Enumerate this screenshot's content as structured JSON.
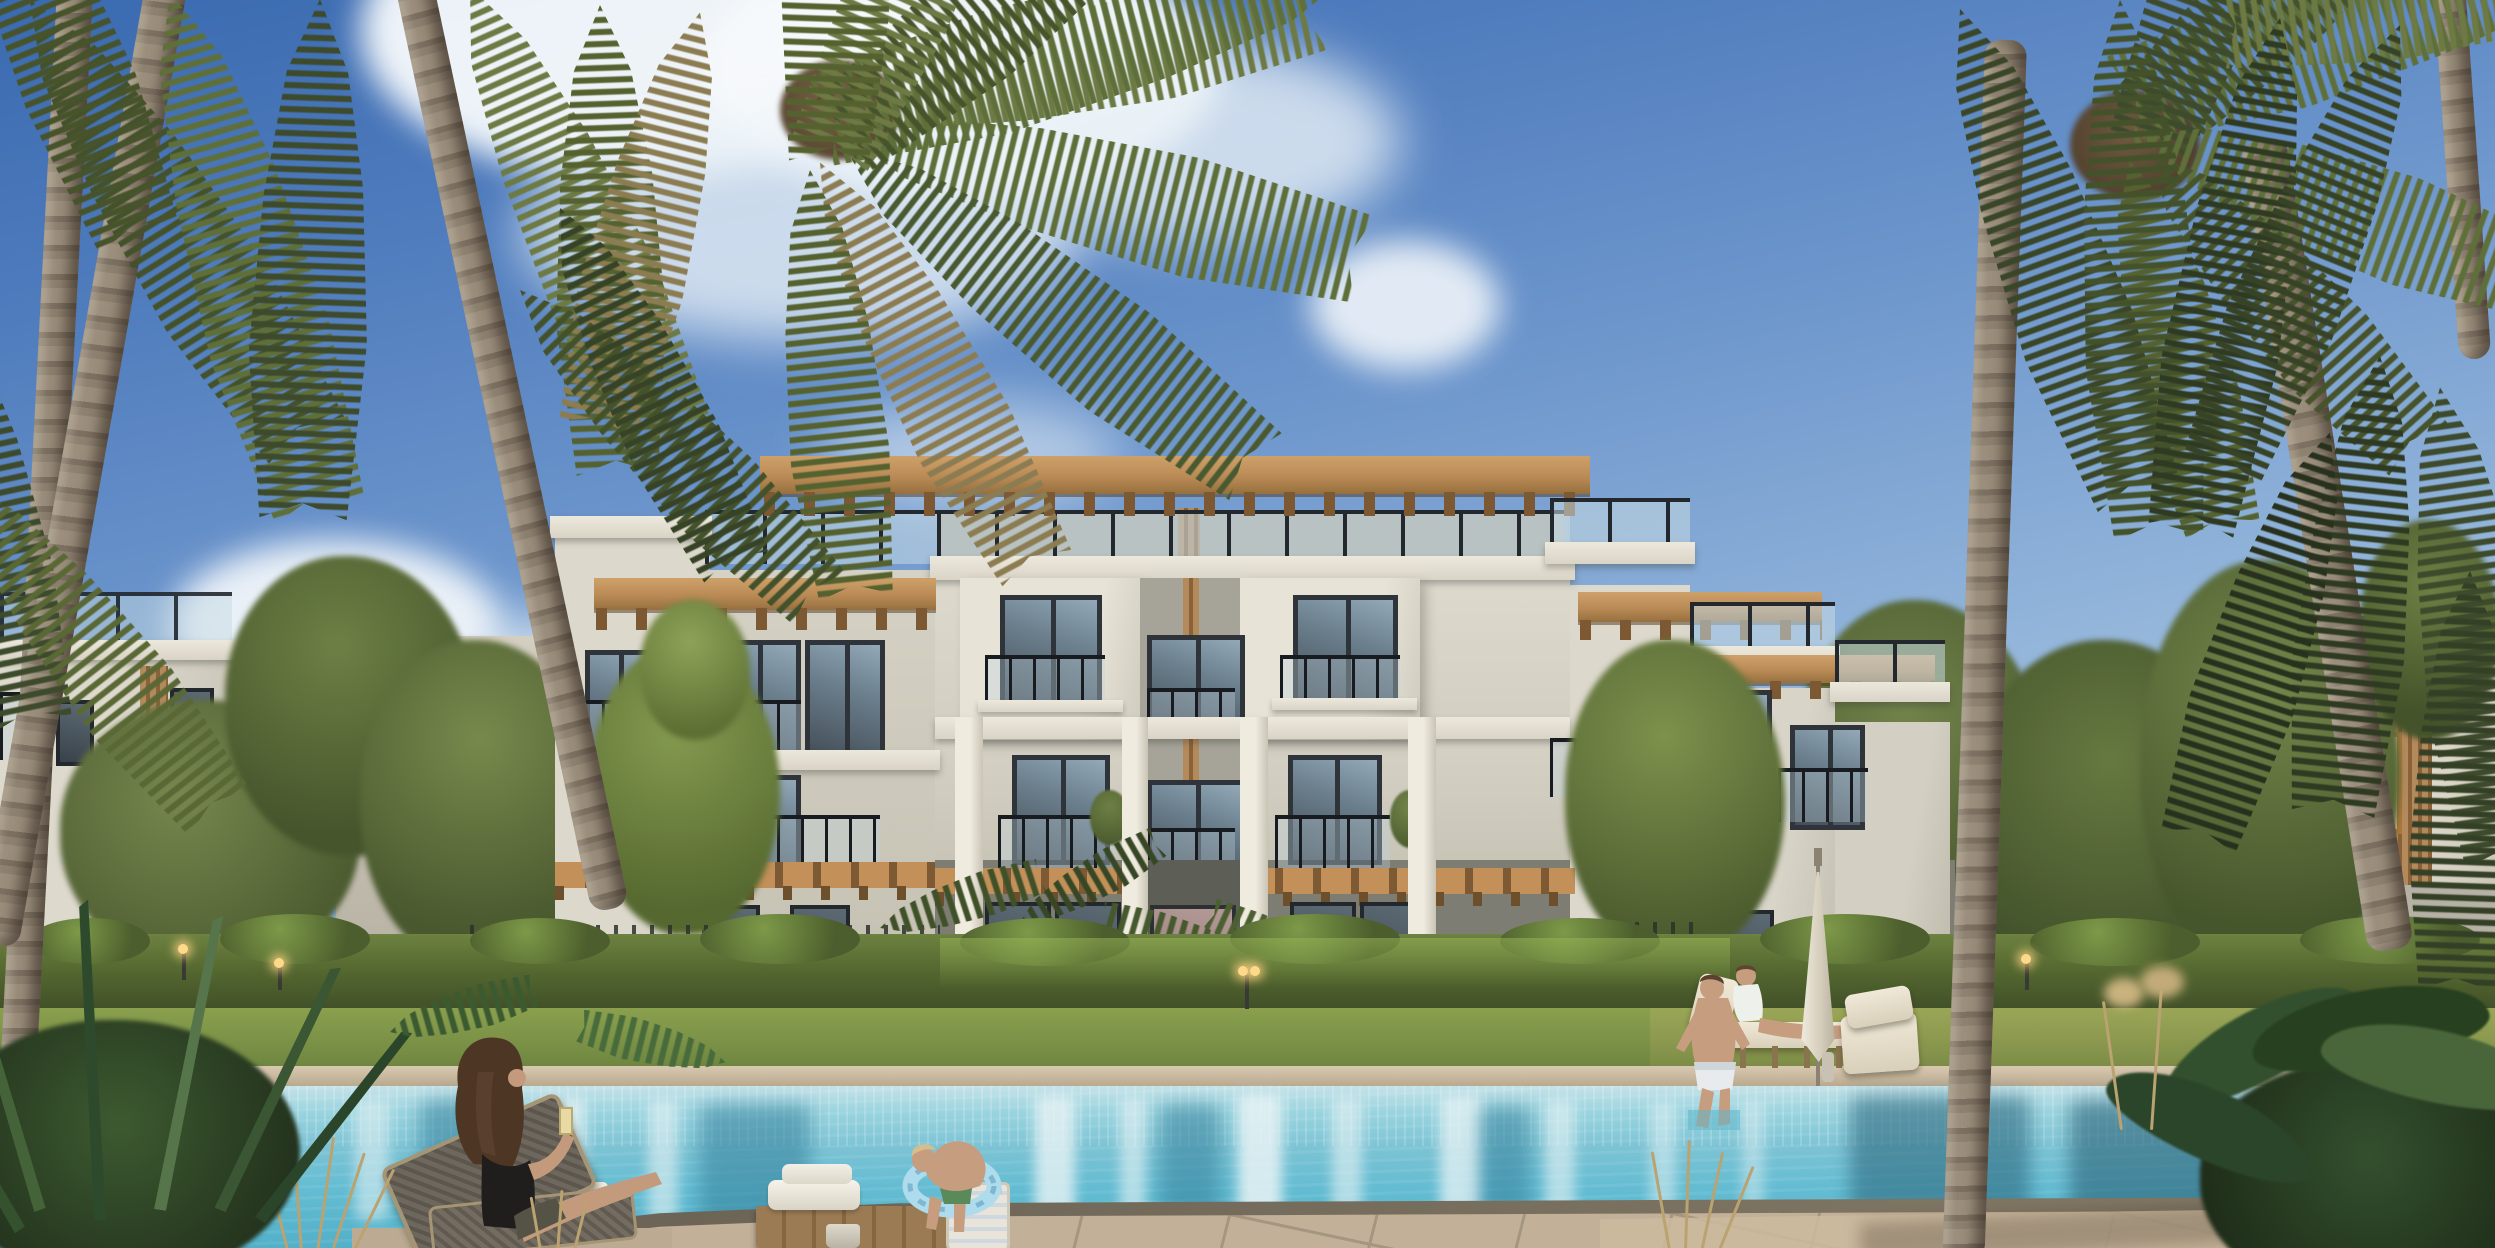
{
  "scene": {
    "type": "architectural-rendering",
    "setting": "residential resort compound with swimming pool at golden daylight",
    "weather": "sunny blue sky with scattered white cumulus clouds",
    "main_building": {
      "stories": 3,
      "style": "modern coastal apartments",
      "features": [
        "rooftop wood pergola with rafter tails",
        "roof terraces with glass and black metal railings",
        "juliet balconies",
        "central recessed bay with vertical wood louver strip",
        "wood slat canopies over ground floor",
        "stepped terraces descending on right wing",
        "white structural columns",
        "ground floor glass doors behind hedge"
      ]
    },
    "side_buildings": [
      "left three-story building with roof railing and wood louver panel",
      "left-rear building behind trees",
      "far-right building with roof railing, wood louvers and one warm lit window"
    ],
    "landscape": [
      "tall coconut palms framing left and right foreground",
      "green leafy trees flanking facade",
      "continuous trimmed hedge behind pool lawn",
      "black picket garden fence segments",
      "curved stone garden walkway",
      "lawn strip",
      "garden bollard lights"
    ],
    "pool_area": [
      "stone coping far edge",
      "turquoise pool with building and palm reflections",
      "flagstone deck near edge",
      "sandy deck right side"
    ],
    "people": [
      {
        "id": "woman-left",
        "description": "woman with long curly brown hair, black swimsuit, seated on woven lounger holding a drink, legs extended toward pool"
      },
      {
        "id": "child-pool-edge",
        "description": "small child in water leaning on near pool edge"
      },
      {
        "id": "child-swim-ring",
        "description": "blond child with light-blue swim ring climbing at pool edge"
      },
      {
        "id": "man-pool-edge-right",
        "description": "shirtless man in striped shorts seated on coping with feet in water"
      },
      {
        "id": "woman-lounger-right",
        "description": "woman in white top reclining on pool lounger"
      },
      {
        "id": "man-balcony",
        "description": "tiny figure of man standing at second-floor balcony of right wing"
      }
    ],
    "furniture": [
      "woven dark lounger left",
      "two cream pool loungers right",
      "closed white patio umbrella",
      "wooden table with stacked white towels",
      "woven beach basket",
      "small bucket",
      "bottle beside lounger"
    ],
    "palette": {
      "sky_top": "#3a6ab0",
      "sky_horizon": "#cadff0",
      "cloud": "#f7fafc",
      "wall_lit": "#dedacf",
      "wall_shadow": "#b3afa3",
      "wall_recess": "#a6a499",
      "ground_floor": "#7e7d73",
      "pergola_wood_light": "#c89a62",
      "pergola_wood_dark": "#8a6138",
      "window_frame": "#2e343a",
      "window_glass": "#7e96a6",
      "railing_black": "#181c20",
      "railing_glass": "#c5d9e2",
      "hedge_lit": "#7d9948",
      "hedge_dark": "#3c4a26",
      "grass": "#87a04e",
      "pool_shallow": "#c5e2e8",
      "pool_mid": "#7cc3d4",
      "pool_deep": "#52b0c8",
      "pool_reflection": "#e8f3f5",
      "coping_stone": "#cfc0a8",
      "deck_flagstone": "#c2b098",
      "deck_joint": "#8f8170",
      "deck_sand": "#cdbb9f",
      "palm_trunk": "#9b8e7c",
      "palm_trunk_shadow": "#6b5f50",
      "frond_green": "#5f6f3a",
      "frond_dark": "#3d4a2c",
      "frond_dry": "#8c7c52",
      "skin": "#c79d80",
      "hair_brown": "#4e3624",
      "swimsuit_black": "#1f1e1c",
      "towel_white": "#f2efe8",
      "wood_furniture": "#9a7b54",
      "swim_ring": "#aedcec",
      "lit_window_glow": "#f3e3c2"
    }
  }
}
